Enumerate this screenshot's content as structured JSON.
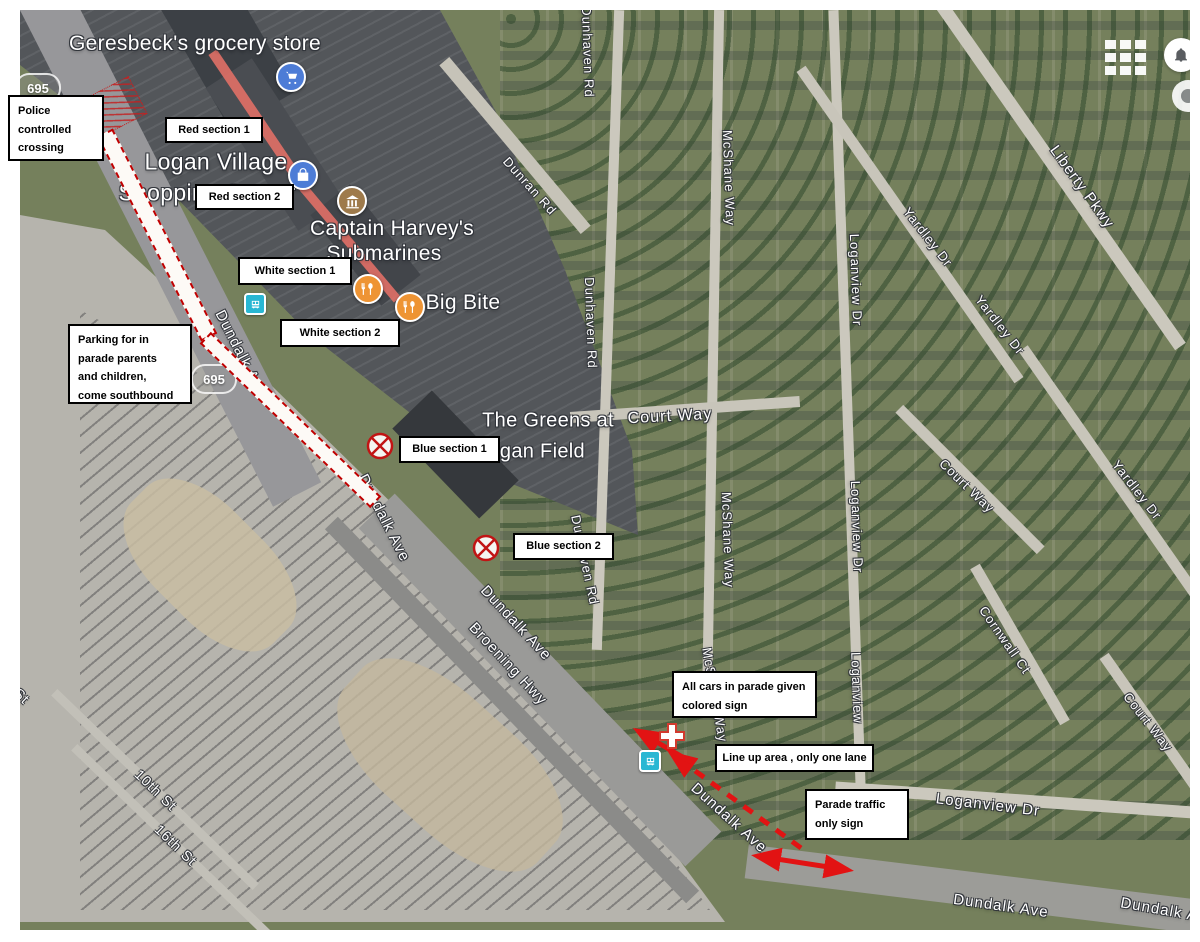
{
  "colors": {
    "route_red": "#c00000",
    "arrow_red": "#e21313",
    "annotation_border": "#000000",
    "poi_blue": "#4d7cd6",
    "poi_orange": "#ee9434",
    "poi_brown": "#9e7a4b",
    "transit_teal": "#29b7d3"
  },
  "map": {
    "poi_labels": [
      {
        "text": "Geresbeck's grocery store"
      },
      {
        "text": "Logan Village"
      },
      {
        "text": "Shopping Center"
      },
      {
        "text": "Captain Harvey's"
      },
      {
        "text": "Submarines"
      },
      {
        "text": "Big Bite"
      },
      {
        "text": "The Greens at"
      },
      {
        "text": "Logan Field"
      }
    ],
    "road_labels": [
      {
        "text": "Dunran Rd"
      },
      {
        "text": "Dunhaven Rd"
      },
      {
        "text": "Dunhaven Rd"
      },
      {
        "text": "Dunhaven Rd"
      },
      {
        "text": "McShane Way"
      },
      {
        "text": "McShane Way"
      },
      {
        "text": "McShane Way"
      },
      {
        "text": "Loganview Dr"
      },
      {
        "text": "Loganview Dr"
      },
      {
        "text": "Loganview"
      },
      {
        "text": "Loganview Dr"
      },
      {
        "text": "Liberty Pkwy"
      },
      {
        "text": "Yardley Dr"
      },
      {
        "text": "Yardley Dr"
      },
      {
        "text": "Yardley Dr"
      },
      {
        "text": "Court Way"
      },
      {
        "text": "Cornwall Ct"
      },
      {
        "text": "Court Way"
      },
      {
        "text": "Court Way"
      },
      {
        "text": "Dundalk Ave"
      },
      {
        "text": "Dundalk Ave"
      },
      {
        "text": "Dundalk Ave"
      },
      {
        "text": "Broening Hwy"
      },
      {
        "text": "Dundalk Ave"
      },
      {
        "text": "Dundalk Ave"
      },
      {
        "text": "Dundalk Ave"
      },
      {
        "text": "10th St"
      },
      {
        "text": "16th St"
      },
      {
        "text": "St"
      }
    ],
    "highway_shields": [
      {
        "text": "695"
      },
      {
        "text": "695"
      }
    ],
    "poi_icons": [
      "shopping-cart",
      "shopping-bag",
      "museum",
      "restaurant",
      "restaurant",
      "bus-stop",
      "bus-stop",
      "first-aid-cross"
    ],
    "ui_icons": [
      "apps-grid",
      "notifications-bell"
    ]
  },
  "annotations": {
    "police_crossing": {
      "lines": [
        "Police",
        "controlled",
        "crossing"
      ]
    },
    "red_section_1": {
      "label": "Red section 1"
    },
    "red_section_2": {
      "label": "Red section 2"
    },
    "white_section_1": {
      "label": "White section 1"
    },
    "white_section_2": {
      "label": "White section 2"
    },
    "blue_section_1": {
      "label": "Blue section 1"
    },
    "blue_section_2": {
      "label": "Blue section 2"
    },
    "parking": {
      "lines": [
        "Parking for in",
        "parade parents",
        "and children,",
        "come southbound"
      ]
    },
    "all_cars": {
      "lines": [
        "All cars in parade given",
        "colored sign"
      ]
    },
    "line_up": {
      "label": "Line up area , only one lane"
    },
    "parade_traffic": {
      "lines": [
        "Parade traffic",
        "only sign"
      ]
    }
  }
}
